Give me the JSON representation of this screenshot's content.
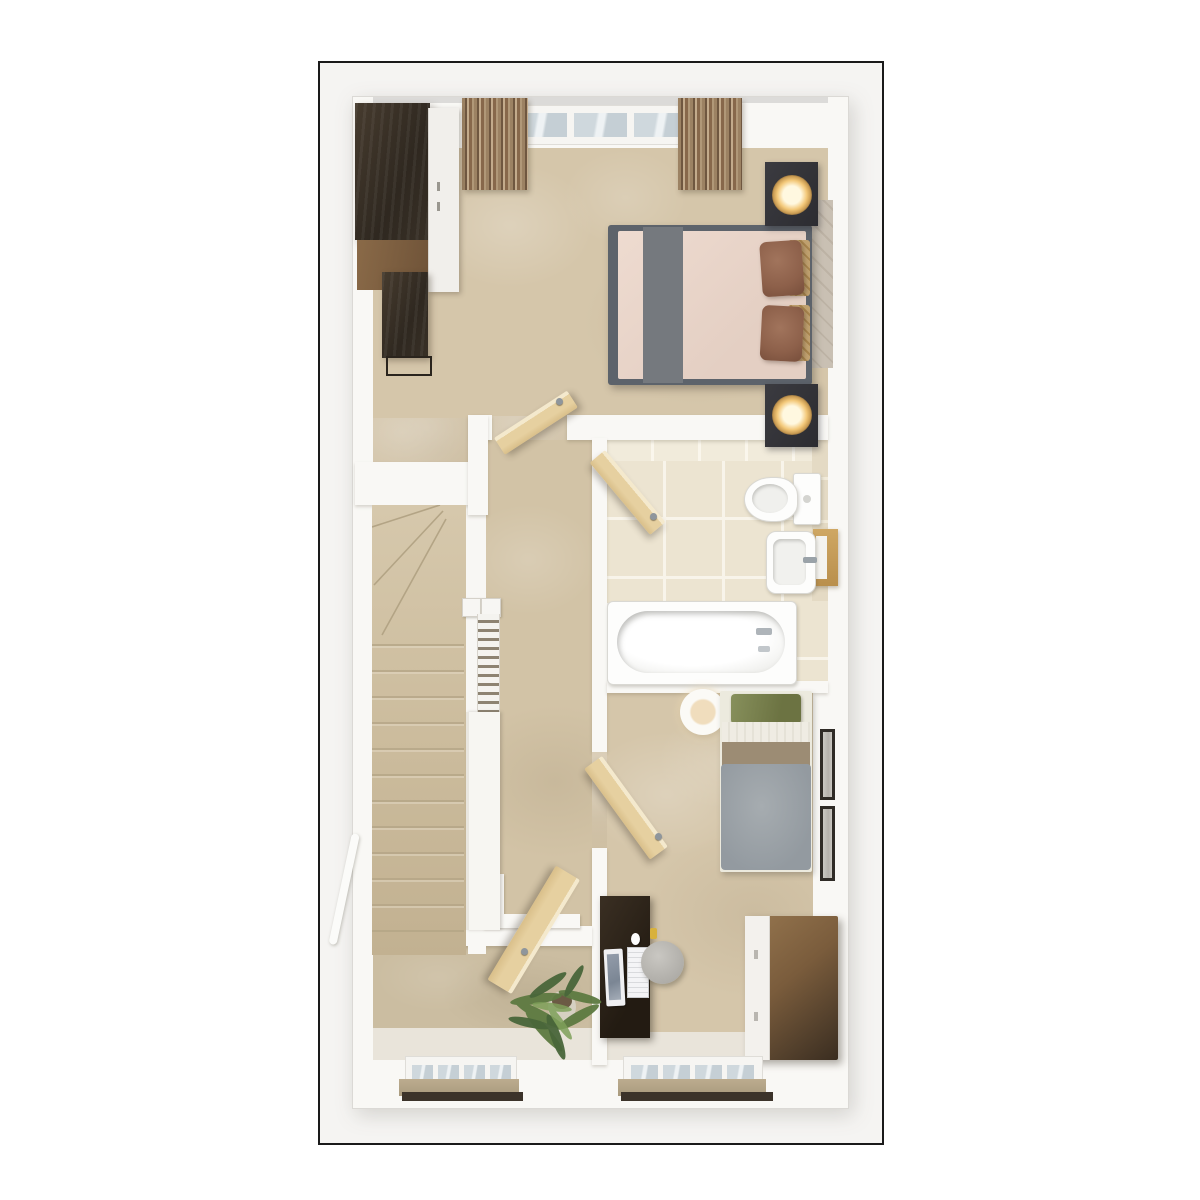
{
  "meta": {
    "type": "3D floor plan rendering",
    "view": "top-down dollhouse cutaway",
    "visible_text": "none",
    "frame_border_color": "#1a1a1a"
  },
  "colors": {
    "carpet": "#d5c6aa",
    "hall_floor": "#e9e4da",
    "wall": "#f9f8f5",
    "tile_floor": "#ece4d1",
    "wood_door": "#e6d0a0",
    "dark_wood": "#372e25",
    "mid_wood": "#7d5f41",
    "bed_frame_gray": "#5d636b",
    "mattress_pink": "#e9d5ca",
    "runner_gray": "#75797e",
    "pillow_brown": "#8d604a",
    "pillow_tan": "#c0a16f",
    "headboard": "#c9c0b3",
    "lamp_gold": "#f3c879",
    "green_pillow": "#78814e",
    "tan_band": "#9c8c74",
    "duvet_gray": "#9ba1a6",
    "stool_gray": "#bbb9b4",
    "sideboard_wood": "#8a6a49",
    "plant_green": "#5d7a41",
    "window_pane": "#cfd8dd",
    "sill_tan": "#b5a68a",
    "sill_dark": "#3c332a"
  },
  "rooms": {
    "master_bedroom": {
      "label": "Master bedroom",
      "furniture": [
        {
          "label": "wardrobe"
        },
        {
          "label": "lowboard dresser"
        },
        {
          "label": "double bed with runner and pillows"
        },
        {
          "label": "nightstand with lamp (top)"
        },
        {
          "label": "nightstand with lamp (bottom)"
        },
        {
          "label": "curtains"
        },
        {
          "label": "window"
        },
        {
          "label": "door"
        }
      ]
    },
    "bathroom": {
      "label": "Bathroom",
      "furniture": [
        {
          "label": "toilet"
        },
        {
          "label": "washbasin"
        },
        {
          "label": "bathtub"
        },
        {
          "label": "wooden shelf"
        },
        {
          "label": "door"
        }
      ]
    },
    "landing": {
      "label": "Landing with staircase",
      "furniture": [
        {
          "label": "winder staircase"
        },
        {
          "label": "balustrade"
        },
        {
          "label": "handrail"
        },
        {
          "label": "door"
        }
      ]
    },
    "bedroom_2": {
      "label": "Bedroom 2",
      "furniture": [
        {
          "label": "single bed"
        },
        {
          "label": "desk with monitor and keyboard"
        },
        {
          "label": "stool"
        },
        {
          "label": "sideboard"
        },
        {
          "label": "ceiling light"
        },
        {
          "label": "wall pictures"
        },
        {
          "label": "window"
        },
        {
          "label": "door"
        }
      ]
    },
    "hallway": {
      "label": "Ground-floor hallway",
      "furniture": [
        {
          "label": "potted plant"
        },
        {
          "label": "window"
        }
      ]
    }
  }
}
